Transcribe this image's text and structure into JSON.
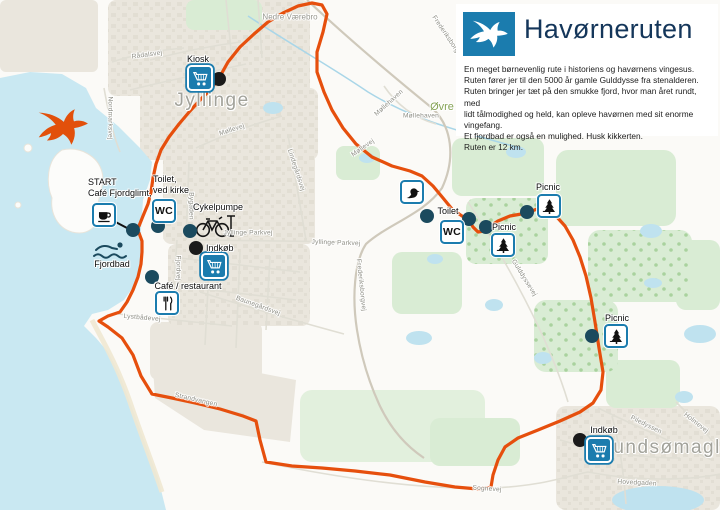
{
  "panel": {
    "title": "Havørneruten",
    "logo_icon": "white-tailed-eagle",
    "description_lines": [
      "En meget børnevenlig rute i historiens og havørnens vingesus.",
      "Ruten fører jer til den 5000 år gamle Gulddysse fra stenalderen.",
      "Ruten bringer jer tæt på den smukke fjord, hvor man året rundt, med",
      "lidt tålmodighed og held, kan opleve havørnen med sit enorme vingefang.",
      "Et fjordbad er også en mulighed. Husk kikkerten.",
      "Ruten er 12 km."
    ]
  },
  "map": {
    "colors": {
      "route_orange": "#e64f0d",
      "marker_blue": "#1b7cae",
      "dot_teal": "#1b4a5e",
      "dot_black": "#1a1a1a",
      "water": "#c9e8f2",
      "urban_beige": "#eae6dd",
      "green": "#d9ecd4",
      "title_navy": "#14365a"
    },
    "towns": [
      {
        "name": "Jyllinge",
        "x": 212,
        "y": 101
      },
      {
        "name": "Gundsømagle",
        "x": 665,
        "y": 448
      }
    ],
    "places": [
      {
        "name": "Nedre Værebro",
        "x": 290,
        "y": 17,
        "color": "#97978f",
        "size": 8,
        "rot": 0
      },
      {
        "name": "Øvre",
        "x": 442,
        "y": 107,
        "color": "#86a356",
        "size": 11,
        "rot": 0
      }
    ],
    "streets": [
      {
        "name": "Rådalsvej",
        "x": 147,
        "y": 55,
        "rot": -8
      },
      {
        "name": "Nordmarksvej",
        "x": 110,
        "y": 118,
        "rot": 90
      },
      {
        "name": "Møllevej",
        "x": 232,
        "y": 130,
        "rot": -18
      },
      {
        "name": "Møllehaven",
        "x": 389,
        "y": 103,
        "rot": -42
      },
      {
        "name": "Møllehaven",
        "x": 421,
        "y": 116,
        "rot": 0
      },
      {
        "name": "Møllevej",
        "x": 363,
        "y": 148,
        "rot": -35
      },
      {
        "name": "Frederiksborgvej",
        "x": 448,
        "y": 38,
        "rot": 56
      },
      {
        "name": "Frederiksborgvej",
        "x": 361,
        "y": 285,
        "rot": 84
      },
      {
        "name": "Lindegårdsvej",
        "x": 296,
        "y": 170,
        "rot": 72
      },
      {
        "name": "Jyllinge Parkvej",
        "x": 248,
        "y": 233,
        "rot": 0
      },
      {
        "name": "Jyllinge Parkvej",
        "x": 336,
        "y": 243,
        "rot": 2
      },
      {
        "name": "Bygaden",
        "x": 191,
        "y": 206,
        "rot": 90
      },
      {
        "name": "Fjordvej",
        "x": 178,
        "y": 268,
        "rot": 90
      },
      {
        "name": "Baunegårdsvej",
        "x": 258,
        "y": 306,
        "rot": 20
      },
      {
        "name": "Lystbådevej",
        "x": 142,
        "y": 318,
        "rot": 5
      },
      {
        "name": "Strandvangen",
        "x": 196,
        "y": 400,
        "rot": 13
      },
      {
        "name": "Gulddyssevej",
        "x": 524,
        "y": 278,
        "rot": 58
      },
      {
        "name": "Piledyssen",
        "x": 646,
        "y": 425,
        "rot": 26
      },
      {
        "name": "Holmevej",
        "x": 696,
        "y": 423,
        "rot": 38
      },
      {
        "name": "Hovedgaden",
        "x": 637,
        "y": 483,
        "rot": 3
      },
      {
        "name": "Sognevej",
        "x": 487,
        "y": 489,
        "rot": 4
      }
    ],
    "pois": [
      {
        "id": "kiosk",
        "label": [
          "Kiosk"
        ],
        "align": "center",
        "label_x": 198,
        "label_y": 54,
        "icon": "cart",
        "icon_x": 200,
        "icon_y": 78,
        "dot_x": 219,
        "dot_y": 79,
        "dot_color": "black"
      },
      {
        "id": "start-cafe-fjordglimt",
        "label": [
          "START",
          "Café Fjordglimt,"
        ],
        "align": "left",
        "label_x": 88,
        "label_y": 177,
        "icon": "cup",
        "icon_x": 104,
        "icon_y": 215,
        "dot_x": 133,
        "dot_y": 230,
        "dot_color": "teal",
        "connector": [
          112,
          219,
          133,
          230
        ]
      },
      {
        "id": "toilet-ved-kirke",
        "label": [
          "Toilet,",
          "ved kirke"
        ],
        "align": "left",
        "label_x": 153,
        "label_y": 174,
        "icon": "wc",
        "icon_x": 164,
        "icon_y": 211,
        "dot_x": 158,
        "dot_y": 226,
        "dot_color": "teal"
      },
      {
        "id": "cykelpumpe",
        "label": [
          "Cykelpumpe"
        ],
        "align": "center",
        "label_x": 218,
        "label_y": 202,
        "icon": "none",
        "dot_x": 190,
        "dot_y": 231,
        "dot_color": "teal"
      },
      {
        "id": "indkoeb-jyllinge",
        "label": [
          "Indkøb"
        ],
        "align": "left",
        "label_x": 206,
        "label_y": 243,
        "icon": "cart",
        "icon_x": 214,
        "icon_y": 266,
        "dot_x": 196,
        "dot_y": 248,
        "dot_color": "black"
      },
      {
        "id": "cafe-restaurant",
        "label": [
          "Café / restaurant"
        ],
        "align": "center",
        "label_x": 188,
        "label_y": 281,
        "icon": "cutlery",
        "icon_x": 167,
        "icon_y": 303,
        "dot_x": 152,
        "dot_y": 277,
        "dot_color": "teal"
      },
      {
        "id": "fjordbad",
        "label": [
          "Fjordbad"
        ],
        "align": "center",
        "label_x": 112,
        "label_y": 259,
        "icon": "none"
      },
      {
        "id": "bird-watching",
        "label": [],
        "icon": "bird",
        "icon_x": 412,
        "icon_y": 192,
        "dot_x": 427,
        "dot_y": 216,
        "dot_color": "teal"
      },
      {
        "id": "toilet-gulddysse",
        "label": [
          "Toilet"
        ],
        "align": "center",
        "label_x": 448,
        "label_y": 206,
        "icon": "wc",
        "icon_x": 452,
        "icon_y": 232,
        "dot_x": 469,
        "dot_y": 219,
        "dot_color": "teal"
      },
      {
        "id": "picnic-1",
        "label": [
          "Picnic"
        ],
        "align": "center",
        "label_x": 504,
        "label_y": 222,
        "icon": "tree",
        "icon_x": 503,
        "icon_y": 245,
        "dot_x": 486,
        "dot_y": 227,
        "dot_color": "teal"
      },
      {
        "id": "picnic-2",
        "label": [
          "Picnic"
        ],
        "align": "center",
        "label_x": 548,
        "label_y": 182,
        "icon": "tree",
        "icon_x": 549,
        "icon_y": 206,
        "dot_x": 527,
        "dot_y": 212,
        "dot_color": "teal"
      },
      {
        "id": "picnic-3",
        "label": [
          "Picnic"
        ],
        "align": "center",
        "label_x": 617,
        "label_y": 313,
        "icon": "tree",
        "icon_x": 616,
        "icon_y": 336,
        "dot_x": 592,
        "dot_y": 336,
        "dot_color": "teal"
      },
      {
        "id": "indkoeb-gundsoemagle",
        "label": [
          "Indkøb"
        ],
        "align": "center",
        "label_x": 604,
        "label_y": 425,
        "icon": "cart",
        "icon_x": 599,
        "icon_y": 450,
        "dot_x": 580,
        "dot_y": 440,
        "dot_color": "black"
      }
    ],
    "route": {
      "color": "#e64f0d",
      "points": "218,80 228,62 240,47 254,34 268,22 283,13 298,6 312,3 322,5 327,14 323,32 317,52 317,72 324,92 332,110 343,128 356,144 372,157 392,166 410,171 422,176 433,186 443,198 452,209 462,216 469,220 473,227 478,232 484,231 489,227 498,221 510,216 527,213 537,209 547,210 556,216 565,226 573,240 580,257 586,276 591,298 595,322 599,348 603,372 601,390 593,403 580,412 560,421 538,430 518,438 505,447 498,460 493,475 491,487 478,489 455,487 425,482 390,475 355,471 322,468 292,466 266,462 260,440 256,421 243,416 220,409 195,403 172,398 152,394 141,376 133,355 122,338 108,327 99,321 108,316 120,312 127,302 133,290 138,277 141,264 142,252 142,241 139,233 135,230 139,226 143,216 148,204 151,192 153,178 156,164 161,150 169,137 179,124 190,111 201,99 210,90 218,80"
    }
  }
}
